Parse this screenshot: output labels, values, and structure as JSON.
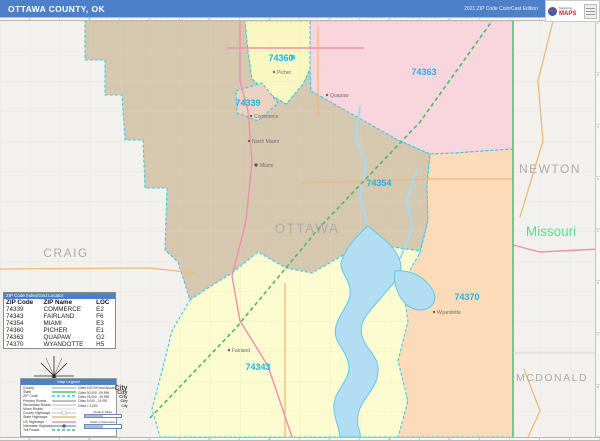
{
  "header": {
    "title": "OTTAWA COUNTY, OK",
    "edition": "2021 ZIP Code ColorCast Edition",
    "logo_brand": "MAPS",
    "logo_sub": "Marketing"
  },
  "ruler": {
    "letters": [
      "A",
      "B",
      "C",
      "D",
      "E",
      "F",
      "G",
      "H",
      "I",
      "J"
    ],
    "numbers": [
      "1",
      "2",
      "3",
      "4",
      "5",
      "6",
      "7",
      "8"
    ]
  },
  "colors": {
    "titlebar_blue": "#4d80c9",
    "outside_gray": "#f2f1ee",
    "miami_tan": "#d6c7af",
    "quapaw_pink": "#f9d5de",
    "wyandotte_peach": "#fcdcb8",
    "fairland_yellow": "#fdfbd0",
    "picher_yellow": "#fbf7c0",
    "commerce_tan": "#ecd2c0",
    "lake_blue": "#b3ddf2",
    "lake_edge": "#5ec9e8",
    "boundary_cyan": "#3fc6e9",
    "state_line_green": "#46c87c",
    "toll_road_green": "#4db86a",
    "us_highway_pink": "#ef8fb0",
    "state_highway_orange": "#edb977",
    "zip_label_blue": "#1db4e9",
    "county_label_gray": "#ababab",
    "missouri_green": "#5fd98d"
  },
  "map": {
    "county_label": "OTTAWA",
    "neighbor_labels": {
      "west": "CRAIG",
      "northeast": "NEWTON",
      "southeast": "MCDONALD"
    },
    "state_label": "Missouri",
    "zip_labels": [
      "74360",
      "74339",
      "74363",
      "74354",
      "74370",
      "74343"
    ],
    "cities": [
      "Picher",
      "Commerce",
      "North Miami",
      "Miami",
      "Quapaw",
      "Fairland",
      "Wyandotte"
    ]
  },
  "zip_table": {
    "bar_title": "ZIP Code Index/Grid Locator",
    "columns": [
      "ZIP Code",
      "ZIP Name",
      "LOC"
    ],
    "rows": [
      [
        "74339",
        "COMMERCE",
        "E2"
      ],
      [
        "74343",
        "FAIRLAND",
        "F6"
      ],
      [
        "74354",
        "MIAMI",
        "E3"
      ],
      [
        "74360",
        "PICHER",
        "E1"
      ],
      [
        "74363",
        "QUAPAW",
        "G2"
      ],
      [
        "74370",
        "WYANDOTTE",
        "H5"
      ]
    ]
  },
  "legend": {
    "bar_title": "Map Legend",
    "line_items": [
      {
        "label": "County",
        "color": "#bdbdbd"
      },
      {
        "label": "State",
        "color": "#46c87c"
      },
      {
        "label": "ZIP Code",
        "color": "#3fc6e9"
      },
      {
        "label": "Primary Roads",
        "color": "#ababab"
      },
      {
        "label": "Secondary Roads",
        "color": "#c2c2c2"
      },
      {
        "label": "Minor Roads",
        "color": "#d8d8d8"
      },
      {
        "label": "County Highways",
        "color": "#cccccc"
      },
      {
        "label": "State Highways",
        "color": "#edb977"
      },
      {
        "label": "US Highways",
        "color": "#ef8fb0"
      },
      {
        "label": "Interstate Highways",
        "color": "#7aa8e0"
      },
      {
        "label": "Toll Roads",
        "color": "#4db86a"
      }
    ],
    "city_items": [
      {
        "label": "Cities 100,000 and Above",
        "sample": "City"
      },
      {
        "label": "Cities 50,000 - 99,999",
        "sample": "City"
      },
      {
        "label": "Cities 25,000 - 49,999",
        "sample": "City"
      },
      {
        "label": "Cities 5,000 - 24,999",
        "sample": "City"
      },
      {
        "label": "Cities < 5,000",
        "sample": "City"
      }
    ],
    "scale": {
      "miles_label": "Scale in Miles",
      "km_label": "Scale in Kilometers"
    }
  }
}
